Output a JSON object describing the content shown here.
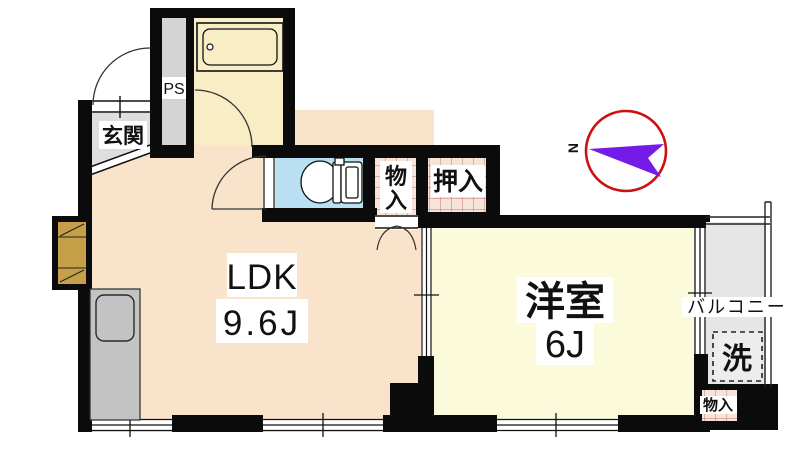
{
  "plan_title": "1LDK apartment floor plan",
  "colors": {
    "wall": "#0b0b0b",
    "ldk_floor": "#FAE3CB",
    "western_room_floor": "#FBFADB",
    "bathroom_floor": "#F8EDC5",
    "toilet_floor": "#B9E0F2",
    "entrance_floor": "#DEDEDE",
    "ps_floor": "#D4D4D4",
    "balcony_floor": "#E6E6E6",
    "kitchen_counter": "#C3C3C3",
    "closet_fill": "#F6E3DA",
    "closet_grid_line": "#CE8B78",
    "cabinet_tan": "#C6A048",
    "compass_ring": "#CC1111",
    "compass_arrow": "#751BE8"
  },
  "compass": {
    "north_label": "N"
  },
  "rooms": {
    "entrance": {
      "label": "玄関"
    },
    "pipe_space": {
      "label": "PS"
    },
    "storage_center": {
      "char_top": "物",
      "char_bottom": "入"
    },
    "closet": {
      "label": "押入"
    },
    "ldk": {
      "label": "LDK",
      "size": "9.6J"
    },
    "western_room": {
      "label": "洋室",
      "size": "6J"
    },
    "balcony": {
      "label": "バルコニー"
    },
    "washer": {
      "label": "洗"
    },
    "storage_corner": {
      "label": "物入"
    }
  }
}
